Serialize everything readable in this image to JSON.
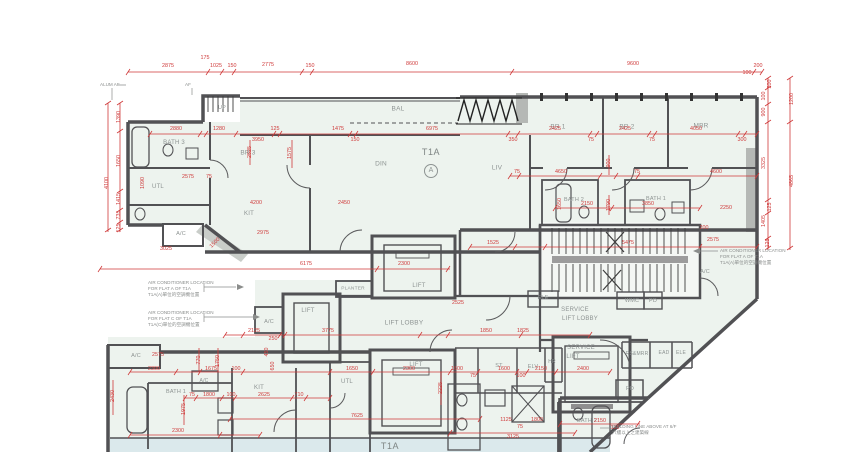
{
  "drawing_title": "T1A",
  "flat_marker": "A",
  "colors": {
    "floor_fill": "#edf3ee",
    "lower_strip_fill": "#dbe9ec",
    "wall": "#515154",
    "shaft_gray": "#9c9c9c",
    "dimension_red": "#cf3a3a",
    "label_gray": "#8d9392"
  },
  "plan": {
    "rooms": [
      {
        "t": "BATH 3",
        "x": 174,
        "y": 143,
        "fs": 6
      },
      {
        "t": "BR 3",
        "x": 248,
        "y": 153,
        "fs": 6.5
      },
      {
        "t": "UTL",
        "x": 158,
        "y": 187,
        "fs": 6
      },
      {
        "t": "UP",
        "x": 222,
        "y": 108,
        "fs": 5.5
      },
      {
        "t": "BAL",
        "x": 398,
        "y": 109,
        "fs": 6.5
      },
      {
        "t": "DIN",
        "x": 381,
        "y": 164,
        "fs": 6.5
      },
      {
        "t": "T1A",
        "x": 431,
        "y": 152,
        "cls": "flat"
      },
      {
        "t": "A",
        "x": 431,
        "y": 171,
        "cls": "circle"
      },
      {
        "t": "LIV",
        "x": 497,
        "y": 168,
        "fs": 6.5
      },
      {
        "t": "BR 1",
        "x": 558,
        "y": 127,
        "fs": 6.5
      },
      {
        "t": "BR 2",
        "x": 627,
        "y": 127,
        "fs": 6.5
      },
      {
        "t": "MBR",
        "x": 701,
        "y": 126,
        "fs": 6.5
      },
      {
        "t": "BATH 2",
        "x": 574,
        "y": 200,
        "fs": 5.5
      },
      {
        "t": "BATH 1",
        "x": 656,
        "y": 199,
        "fs": 5.5
      },
      {
        "t": "KIT",
        "x": 249,
        "y": 214,
        "fs": 6
      },
      {
        "t": "A/C",
        "x": 181,
        "y": 234,
        "fs": 5.5
      },
      {
        "t": "A/C",
        "x": 705,
        "y": 272,
        "fs": 5.5
      },
      {
        "t": "PLANTER",
        "x": 353,
        "y": 289,
        "fs": 4.8
      },
      {
        "t": "LIFT",
        "x": 419,
        "y": 286,
        "fs": 6
      },
      {
        "t": "LIFT",
        "x": 308,
        "y": 311,
        "fs": 6
      },
      {
        "t": "A/C",
        "x": 269,
        "y": 322,
        "fs": 5.5
      },
      {
        "t": "LIFT LOBBY",
        "x": 404,
        "y": 323,
        "fs": 6.5
      },
      {
        "t": "ELE",
        "x": 543,
        "y": 298,
        "fs": 5.5
      },
      {
        "t": "SERVICE",
        "x": 575,
        "y": 310,
        "fs": 6
      },
      {
        "t": "LIFT LOBBY",
        "x": 580,
        "y": 319,
        "fs": 6
      },
      {
        "t": "WMC",
        "x": 632,
        "y": 301,
        "fs": 5.5
      },
      {
        "t": "PD",
        "x": 653,
        "y": 301,
        "fs": 5.5
      },
      {
        "t": "ST",
        "x": 499,
        "y": 366,
        "fs": 5.5
      },
      {
        "t": "ELV",
        "x": 533,
        "y": 367,
        "fs": 5.5
      },
      {
        "t": "HR",
        "x": 552,
        "y": 362,
        "fs": 5
      },
      {
        "t": "SERVICE",
        "x": 581,
        "y": 348,
        "fs": 6
      },
      {
        "t": "LIFT",
        "x": 573,
        "y": 357,
        "fs": 6
      },
      {
        "t": "RS&MRR",
        "x": 637,
        "y": 354,
        "fs": 5
      },
      {
        "t": "EAD",
        "x": 664,
        "y": 353,
        "fs": 5
      },
      {
        "t": "ELE",
        "x": 681,
        "y": 353,
        "fs": 5
      },
      {
        "t": "PD",
        "x": 630,
        "y": 389,
        "fs": 5.5
      },
      {
        "t": "LIFT",
        "x": 416,
        "y": 365,
        "fs": 6
      },
      {
        "t": "A/C",
        "x": 136,
        "y": 356,
        "fs": 5.5
      },
      {
        "t": "BATH 1",
        "x": 176,
        "y": 392,
        "fs": 5.5
      },
      {
        "t": "A/C",
        "x": 204,
        "y": 381,
        "fs": 5
      },
      {
        "t": "KIT",
        "x": 259,
        "y": 388,
        "fs": 6
      },
      {
        "t": "UTL",
        "x": 347,
        "y": 382,
        "fs": 6
      },
      {
        "t": "BATH 2",
        "x": 587,
        "y": 421,
        "fs": 5.5
      },
      {
        "t": "T1A",
        "x": 390,
        "y": 446,
        "cls": "flat"
      }
    ],
    "dims": [
      {
        "t": "2875",
        "x": 168,
        "y": 66
      },
      {
        "t": "175",
        "x": 205,
        "y": 58
      },
      {
        "t": "1025",
        "x": 216,
        "y": 66
      },
      {
        "t": "150",
        "x": 232,
        "y": 66
      },
      {
        "t": "2775",
        "x": 268,
        "y": 65
      },
      {
        "t": "150",
        "x": 310,
        "y": 66
      },
      {
        "t": "8600",
        "x": 412,
        "y": 64
      },
      {
        "t": "9600",
        "x": 633,
        "y": 64
      },
      {
        "t": "200",
        "x": 758,
        "y": 66
      },
      {
        "t": "100",
        "x": 747,
        "y": 73
      },
      {
        "t": "1390",
        "x": 119,
        "y": 117,
        "r": -90
      },
      {
        "t": "1650",
        "x": 119,
        "y": 161,
        "r": -90
      },
      {
        "t": "4100",
        "x": 107,
        "y": 183,
        "r": -90
      },
      {
        "t": "1415",
        "x": 119,
        "y": 199,
        "r": -90
      },
      {
        "t": "735",
        "x": 119,
        "y": 215,
        "r": -90
      },
      {
        "t": "125",
        "x": 119,
        "y": 228,
        "r": -90
      },
      {
        "t": "200",
        "x": 770,
        "y": 84,
        "r": -90
      },
      {
        "t": "100",
        "x": 764,
        "y": 96,
        "r": -90
      },
      {
        "t": "900",
        "x": 764,
        "y": 112,
        "r": -90
      },
      {
        "t": "1200",
        "x": 792,
        "y": 99,
        "r": -90
      },
      {
        "t": "3325",
        "x": 764,
        "y": 163,
        "r": -90
      },
      {
        "t": "4865",
        "x": 792,
        "y": 181,
        "r": -90
      },
      {
        "t": "125",
        "x": 770,
        "y": 207,
        "r": -90
      },
      {
        "t": "1405",
        "x": 764,
        "y": 221,
        "r": -90
      },
      {
        "t": "125",
        "x": 768,
        "y": 243,
        "r": -90
      },
      {
        "t": "2880",
        "x": 176,
        "y": 129
      },
      {
        "t": "1280",
        "x": 219,
        "y": 129
      },
      {
        "t": "3950",
        "x": 258,
        "y": 140
      },
      {
        "t": "125",
        "x": 275,
        "y": 129
      },
      {
        "t": "1475",
        "x": 338,
        "y": 129
      },
      {
        "t": "150",
        "x": 355,
        "y": 140
      },
      {
        "t": "6975",
        "x": 432,
        "y": 129
      },
      {
        "t": "350",
        "x": 513,
        "y": 140
      },
      {
        "t": "2425",
        "x": 555,
        "y": 129
      },
      {
        "t": "75",
        "x": 591,
        "y": 140
      },
      {
        "t": "2425",
        "x": 625,
        "y": 129
      },
      {
        "t": "75",
        "x": 652,
        "y": 140
      },
      {
        "t": "4050",
        "x": 696,
        "y": 129
      },
      {
        "t": "300",
        "x": 742,
        "y": 140
      },
      {
        "t": "1575",
        "x": 290,
        "y": 153,
        "r": -90
      },
      {
        "t": "2525",
        "x": 250,
        "y": 152,
        "r": -90
      },
      {
        "t": "1090",
        "x": 143,
        "y": 183,
        "r": -90
      },
      {
        "t": "2575",
        "x": 188,
        "y": 177
      },
      {
        "t": "75",
        "x": 209,
        "y": 177
      },
      {
        "t": "4200",
        "x": 256,
        "y": 203
      },
      {
        "t": "2450",
        "x": 344,
        "y": 203
      },
      {
        "t": "2975",
        "x": 263,
        "y": 233
      },
      {
        "t": "1500",
        "x": 215,
        "y": 243,
        "r": -45
      },
      {
        "t": "3025",
        "x": 166,
        "y": 249
      },
      {
        "t": "6175",
        "x": 306,
        "y": 264
      },
      {
        "t": "2300",
        "x": 404,
        "y": 264
      },
      {
        "t": "75",
        "x": 517,
        "y": 172
      },
      {
        "t": "4650",
        "x": 561,
        "y": 172
      },
      {
        "t": "900",
        "x": 609,
        "y": 163,
        "r": -90
      },
      {
        "t": "75",
        "x": 637,
        "y": 172
      },
      {
        "t": "4600",
        "x": 716,
        "y": 172
      },
      {
        "t": "2250",
        "x": 726,
        "y": 208
      },
      {
        "t": "2150",
        "x": 587,
        "y": 204
      },
      {
        "t": "3850",
        "x": 648,
        "y": 204
      },
      {
        "t": "1790",
        "x": 609,
        "y": 205,
        "r": -90
      },
      {
        "t": "1650",
        "x": 560,
        "y": 204,
        "r": -90
      },
      {
        "t": "1525",
        "x": 493,
        "y": 243
      },
      {
        "t": "5475",
        "x": 628,
        "y": 243
      },
      {
        "t": "2575",
        "x": 713,
        "y": 240
      },
      {
        "t": "200",
        "x": 704,
        "y": 228
      },
      {
        "t": "2525",
        "x": 458,
        "y": 303
      },
      {
        "t": "1850",
        "x": 486,
        "y": 331
      },
      {
        "t": "1825",
        "x": 523,
        "y": 331
      },
      {
        "t": "2125",
        "x": 254,
        "y": 331
      },
      {
        "t": "250",
        "x": 273,
        "y": 339
      },
      {
        "t": "3775",
        "x": 328,
        "y": 331
      },
      {
        "t": "450",
        "x": 267,
        "y": 352,
        "r": -90
      },
      {
        "t": "650",
        "x": 273,
        "y": 366,
        "r": -90
      },
      {
        "t": "770",
        "x": 199,
        "y": 360,
        "r": -90
      },
      {
        "t": "1750",
        "x": 218,
        "y": 361,
        "r": -90
      },
      {
        "t": "2575",
        "x": 158,
        "y": 355
      },
      {
        "t": "2300",
        "x": 154,
        "y": 369
      },
      {
        "t": "1675",
        "x": 211,
        "y": 369
      },
      {
        "t": "100",
        "x": 236,
        "y": 369
      },
      {
        "t": "1650",
        "x": 352,
        "y": 369
      },
      {
        "t": "2300",
        "x": 409,
        "y": 369
      },
      {
        "t": "1600",
        "x": 457,
        "y": 369
      },
      {
        "t": "75",
        "x": 473,
        "y": 376
      },
      {
        "t": "1600",
        "x": 504,
        "y": 369
      },
      {
        "t": "100",
        "x": 521,
        "y": 376
      },
      {
        "t": "2150",
        "x": 541,
        "y": 369
      },
      {
        "t": "2400",
        "x": 583,
        "y": 369
      },
      {
        "t": "75",
        "x": 192,
        "y": 395
      },
      {
        "t": "1800",
        "x": 209,
        "y": 395
      },
      {
        "t": "100",
        "x": 231,
        "y": 395
      },
      {
        "t": "2625",
        "x": 264,
        "y": 395
      },
      {
        "t": "710",
        "x": 299,
        "y": 395
      },
      {
        "t": "1975",
        "x": 184,
        "y": 409,
        "r": -90
      },
      {
        "t": "2430",
        "x": 113,
        "y": 396,
        "r": -90
      },
      {
        "t": "2225",
        "x": 441,
        "y": 388,
        "r": -90
      },
      {
        "t": "2300",
        "x": 178,
        "y": 431
      },
      {
        "t": "7625",
        "x": 357,
        "y": 416
      },
      {
        "t": "1125",
        "x": 506,
        "y": 420
      },
      {
        "t": "75",
        "x": 520,
        "y": 427
      },
      {
        "t": "1800",
        "x": 537,
        "y": 420
      },
      {
        "t": "3125",
        "x": 513,
        "y": 437
      },
      {
        "t": "2150",
        "x": 600,
        "y": 421
      },
      {
        "t": "125",
        "x": 615,
        "y": 428
      }
    ],
    "notes": [
      {
        "x": 100,
        "y": 82,
        "lines": [
          "ALUM AF"
        ]
      },
      {
        "x": 185,
        "y": 82,
        "lines": [
          "AF"
        ]
      },
      {
        "x": 148,
        "y": 280,
        "lines": [
          "AIR CONDITIONER LOCATION",
          "FOR FLAT A OF T1A",
          "T1A(A)單位的空調機位置"
        ]
      },
      {
        "x": 148,
        "y": 310,
        "lines": [
          "AIR CONDITIONER LOCATION",
          "FOR FLAT C OF T1A",
          "T1A(C)單位的空調機位置"
        ]
      },
      {
        "x": 720,
        "y": 248,
        "lines": [
          "AIR CONDITIONER LOCATION",
          "FOR FLAT A OF T1A",
          "T1A(A)單位的空調機位置"
        ]
      },
      {
        "x": 612,
        "y": 424,
        "lines": [
          "BUILDING LINE ABOVE AT 6/F",
          "六樓以上之建築線"
        ]
      }
    ]
  }
}
